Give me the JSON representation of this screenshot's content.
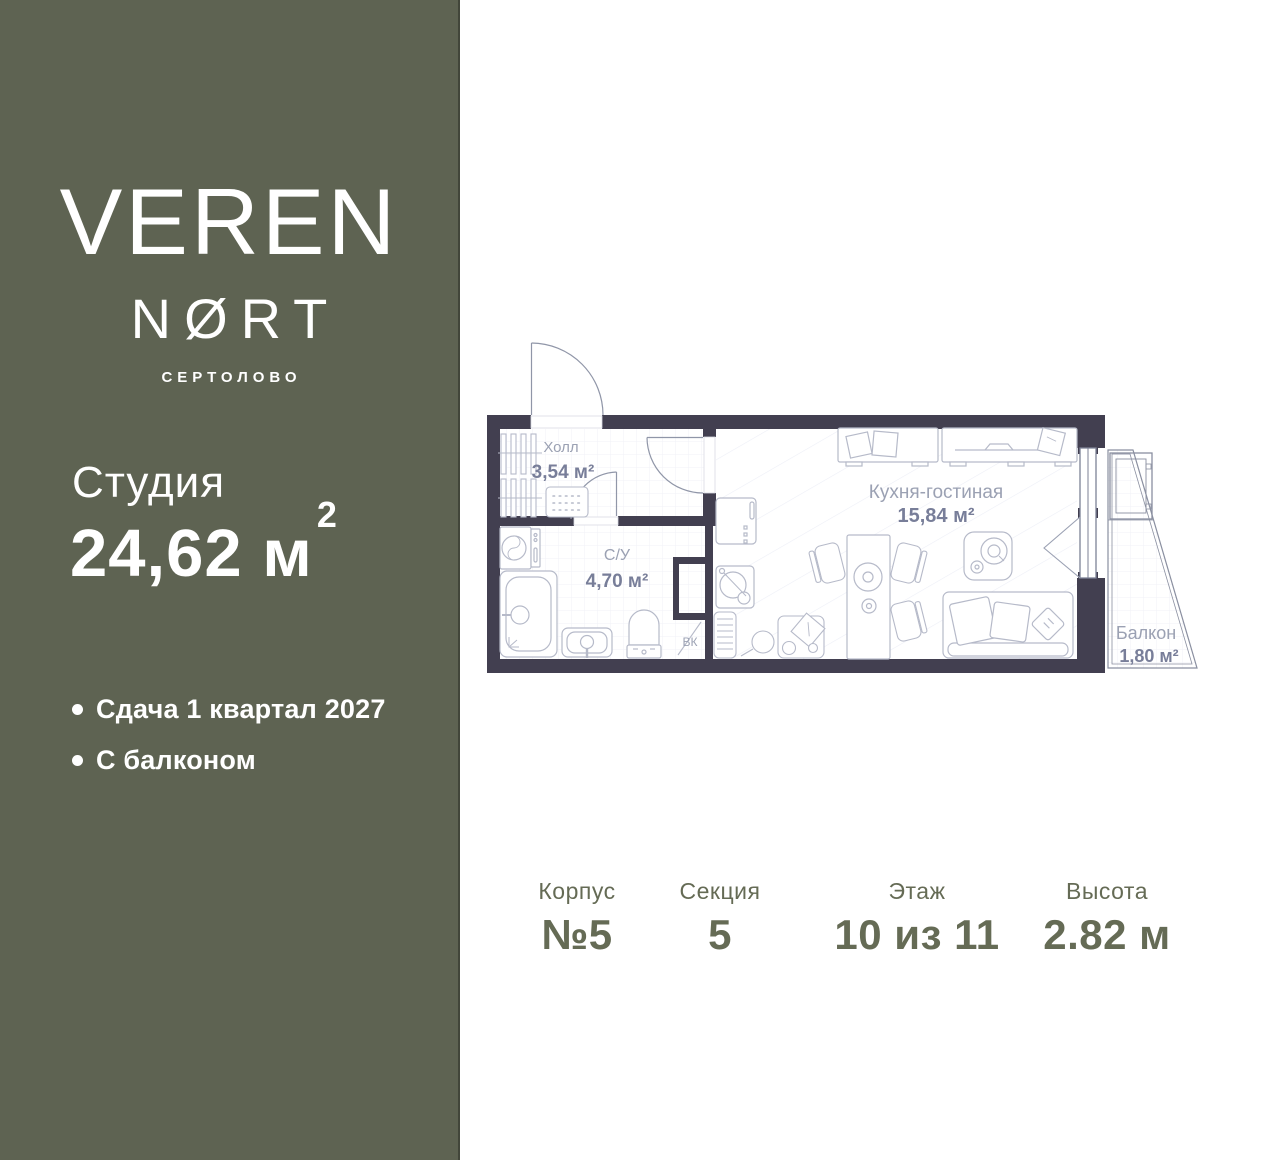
{
  "colors": {
    "sidebar": "#5e6352",
    "wall": "#423f50",
    "fixture_stroke": "#b6bac9",
    "door_stroke": "#9096a8",
    "room_label": "#9ba1b3",
    "room_area": "#787e99",
    "details_text": "#656b55"
  },
  "brand": {
    "line1": "VEREN",
    "line2": "NØRT",
    "location": "СЕРТОЛОВО"
  },
  "unit": {
    "type_label": "Студия",
    "area_value": "24,62",
    "area_unit": "м",
    "area_sup": "2"
  },
  "features": [
    {
      "text": "Сдача 1 квартал 2027"
    },
    {
      "text": "С балконом"
    }
  ],
  "floorplan": {
    "rooms": [
      {
        "name": "Холл",
        "area": "3,54 м²"
      },
      {
        "name": "С/У",
        "area": "4,70 м²"
      },
      {
        "name": "Кухня-гостиная",
        "area": "15,84 м²"
      },
      {
        "name": "Балкон",
        "area": "1,80 м²"
      }
    ],
    "shaft_label": "ВК"
  },
  "details": [
    {
      "label": "Корпус",
      "value": "№5"
    },
    {
      "label": "Секция",
      "value": "5"
    },
    {
      "label": "Этаж",
      "value": "10 из 11"
    },
    {
      "label": "Высота",
      "value": "2.82 м"
    }
  ]
}
